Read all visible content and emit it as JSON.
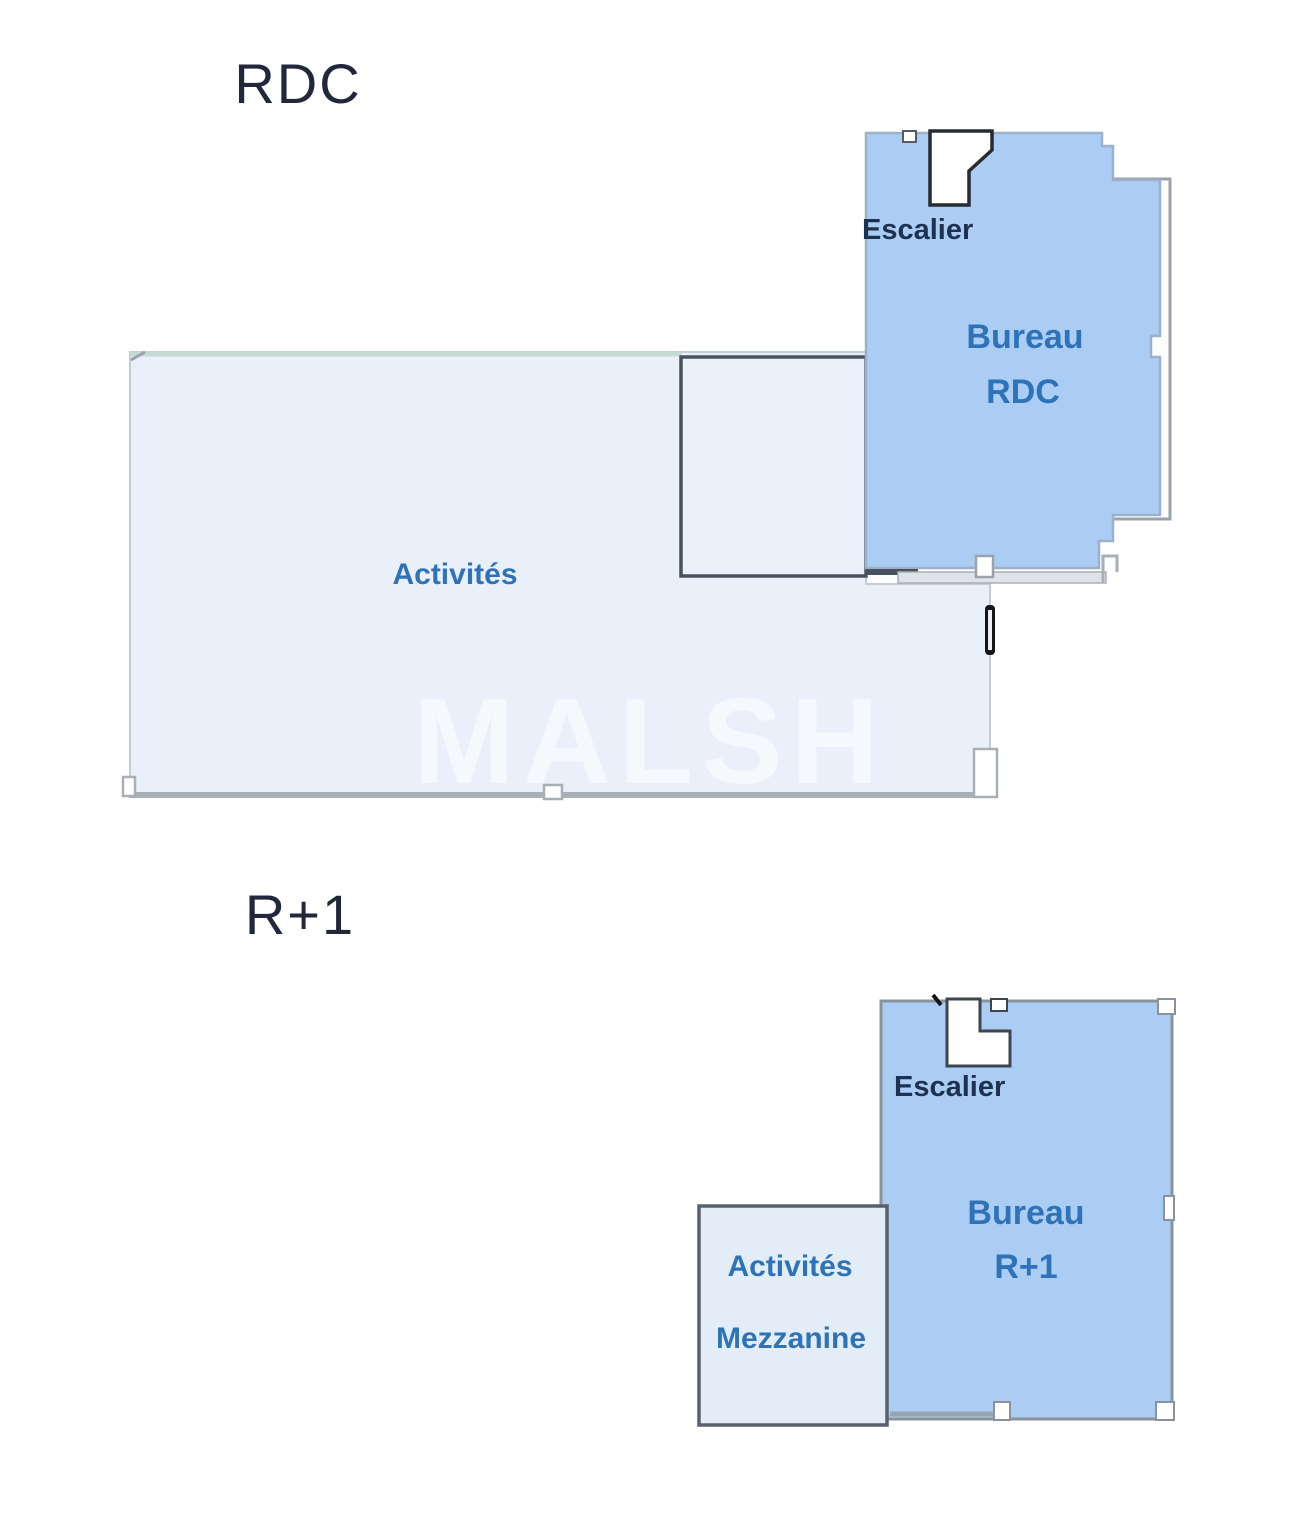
{
  "colors": {
    "bureau_fill": "#abcdf3",
    "bureau_stroke": "#9cb0ca",
    "activites_fill": "#eaf0f9",
    "mezzanine_fill": "#e3edf8",
    "room_label": "#2e73b8",
    "escalier_label": "#1d3150",
    "title": "#23273c",
    "watermark": "#ffffff",
    "wall_dark": "#47525e",
    "wall_gray": "#a9afb6",
    "teal_edge": "#c7d9d3"
  },
  "rdc": {
    "title": "RDC",
    "activites_label": "Activités",
    "escalier_label": "Escalier",
    "bureau_label_line1": "Bureau",
    "bureau_label_line2": "RDC"
  },
  "r1": {
    "title": "R+1",
    "escalier_label": "Escalier",
    "bureau_label_line1": "Bureau",
    "bureau_label_line2": "R+1",
    "mezzanine_label_line1": "Activités",
    "mezzanine_label_line2": "Mezzanine"
  },
  "watermark": {
    "text": "MALSH"
  }
}
